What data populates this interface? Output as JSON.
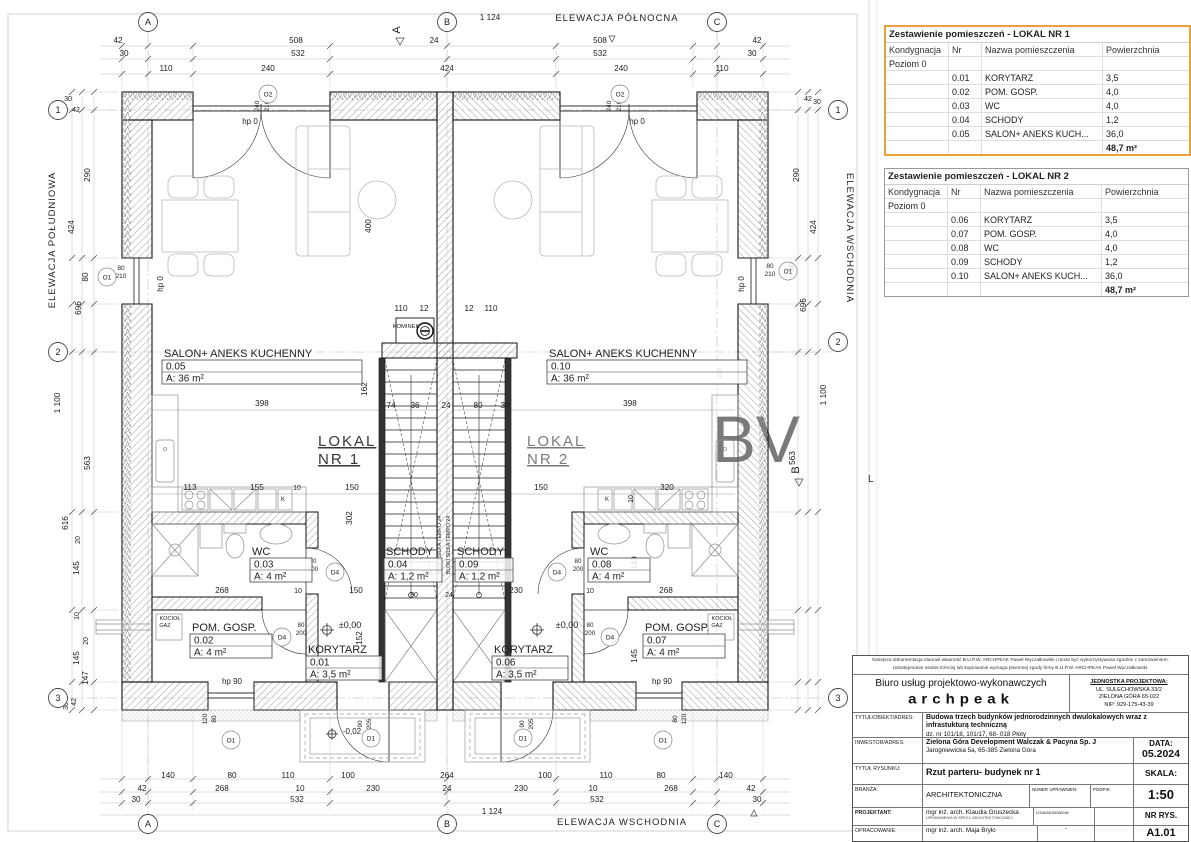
{
  "plan": {
    "elevations": {
      "north": "ELEWACJA PÓŁNOCNA",
      "south": "ELEWACJA POŁUDNIOWA",
      "east_right": "ELEWACJA WSCHODNIA",
      "east_bottom": "ELEWACJA WSCHODNIA"
    },
    "watermark": {
      "big": "BV",
      "small": "L"
    },
    "grid_bubbles": [
      {
        "t": "A",
        "x": 148,
        "y": 22
      },
      {
        "t": "B",
        "x": 447,
        "y": 22
      },
      {
        "t": "C",
        "x": 717,
        "y": 22
      },
      {
        "t": "A",
        "x": 148,
        "y": 824
      },
      {
        "t": "B",
        "x": 447,
        "y": 824
      },
      {
        "t": "C",
        "x": 717,
        "y": 824
      },
      {
        "t": "1",
        "x": 58,
        "y": 110
      },
      {
        "t": "2",
        "x": 58,
        "y": 352
      },
      {
        "t": "3",
        "x": 58,
        "y": 698
      },
      {
        "t": "1",
        "x": 838,
        "y": 110
      },
      {
        "t": "2",
        "x": 838,
        "y": 342
      },
      {
        "t": "3",
        "x": 838,
        "y": 698
      }
    ],
    "section_marks": [
      {
        "t": "A",
        "x": 400,
        "y": 30
      },
      {
        "t": "B",
        "x": 799,
        "y": 470
      }
    ],
    "symbols": [
      {
        "t": "O2",
        "x": 268,
        "y": 94
      },
      {
        "t": "O2",
        "x": 620,
        "y": 94
      },
      {
        "t": "O1",
        "x": 107,
        "y": 277
      },
      {
        "t": "O1",
        "x": 788,
        "y": 271
      },
      {
        "t": "O1",
        "x": 231,
        "y": 740
      },
      {
        "t": "O1",
        "x": 663,
        "y": 740
      },
      {
        "t": "D4",
        "x": 335,
        "y": 572
      },
      {
        "t": "D4",
        "x": 282,
        "y": 637
      },
      {
        "t": "D4",
        "x": 557,
        "y": 572
      },
      {
        "t": "D4",
        "x": 610,
        "y": 637
      },
      {
        "t": "D1",
        "x": 371,
        "y": 738
      },
      {
        "t": "D1",
        "x": 523,
        "y": 738
      }
    ],
    "room_labels": [
      {
        "name": "SALON+ ANEKS KUCHENNY",
        "nr": "0.05",
        "area": "A: 36 m²",
        "x": 162,
        "y": 360,
        "w": 200
      },
      {
        "name": "SALON+ ANEKS KUCHENNY",
        "nr": "0.10",
        "area": "A: 36 m²",
        "x": 547,
        "y": 360,
        "w": 200
      },
      {
        "name": "WC",
        "nr": "0.03",
        "area": "A: 4 m²",
        "x": 250,
        "y": 558,
        "w": 62
      },
      {
        "name": "WC",
        "nr": "0.08",
        "area": "A: 4 m²",
        "x": 588,
        "y": 558,
        "w": 62
      },
      {
        "name": "SCHODY",
        "nr": "0.04",
        "area": "A: 1,2 m²",
        "x": 384,
        "y": 558,
        "w": 58
      },
      {
        "name": "SCHODY",
        "nr": "0.09",
        "area": "A: 1,2 m²",
        "x": 455,
        "y": 558,
        "w": 58
      },
      {
        "name": "POM. GOSP.",
        "nr": "0.02",
        "area": "A: 4 m²",
        "x": 190,
        "y": 634,
        "w": 82
      },
      {
        "name": "POM. GOSP.",
        "nr": "0.07",
        "area": "A: 4 m²",
        "x": 643,
        "y": 634,
        "w": 82
      },
      {
        "name": "KORYTARZ",
        "nr": "0.01",
        "area": "A: 3,5 m²",
        "x": 306,
        "y": 656,
        "w": 76
      },
      {
        "name": "KORYTARZ",
        "nr": "0.06",
        "area": "A: 3,5 m²",
        "x": 492,
        "y": 656,
        "w": 76
      }
    ],
    "unit_marks": [
      {
        "line1": "LOKAL",
        "line2": "NR 1",
        "x": 318,
        "y": 446,
        "color": "#dfa163",
        "opacity": 0.9
      },
      {
        "line1": "LOKAL",
        "line2": "NR 2",
        "x": 527,
        "y": 446,
        "color": "#a3b8d8",
        "opacity": 0.6
      }
    ],
    "dims": [
      [
        "1 124",
        490,
        20
      ],
      [
        "42",
        118,
        43
      ],
      [
        "508",
        296,
        43
      ],
      [
        "24",
        434,
        43
      ],
      [
        "508",
        600,
        43
      ],
      [
        "42",
        757,
        43
      ],
      [
        "30",
        124,
        56
      ],
      [
        "532",
        298,
        56
      ],
      [
        "532",
        600,
        56
      ],
      [
        "30",
        752,
        56
      ],
      [
        "110",
        166,
        71
      ],
      [
        "240",
        268,
        71
      ],
      [
        "424",
        447,
        71
      ],
      [
        "240",
        621,
        71
      ],
      [
        "110",
        722,
        71
      ],
      [
        "240",
        259,
        106,
        1,
        6.5
      ],
      [
        "210",
        269,
        106,
        1,
        6.5
      ],
      [
        "240",
        611,
        106,
        1,
        6.5
      ],
      [
        "210",
        621,
        106,
        1,
        6.5
      ],
      [
        "140",
        168,
        778
      ],
      [
        "80",
        232,
        778
      ],
      [
        "110",
        288,
        778
      ],
      [
        "100",
        348,
        778
      ],
      [
        "264",
        447,
        778
      ],
      [
        "100",
        545,
        778
      ],
      [
        "110",
        606,
        778
      ],
      [
        "80",
        661,
        778
      ],
      [
        "140",
        726,
        778
      ],
      [
        "42",
        142,
        791
      ],
      [
        "268",
        222,
        791
      ],
      [
        "10",
        300,
        791
      ],
      [
        "230",
        373,
        791
      ],
      [
        "24",
        447,
        791
      ],
      [
        "230",
        521,
        791
      ],
      [
        "10",
        593,
        791
      ],
      [
        "268",
        671,
        791
      ],
      [
        "42",
        751,
        791
      ],
      [
        "30",
        136,
        802
      ],
      [
        "532",
        297,
        802
      ],
      [
        "532",
        597,
        802
      ],
      [
        "30",
        757,
        802
      ],
      [
        "1 124",
        492,
        814
      ],
      [
        "90",
        362,
        724,
        1,
        6.5
      ],
      [
        "205",
        371,
        724,
        1,
        6.5
      ],
      [
        "90",
        524,
        724,
        1,
        6.5
      ],
      [
        "205",
        533,
        724,
        1,
        6.5
      ],
      [
        "80",
        677,
        719,
        1,
        6.5
      ],
      [
        "120",
        686,
        719,
        1,
        6.5
      ],
      [
        "80",
        216,
        719,
        1,
        6.5
      ],
      [
        "120",
        207,
        719,
        1,
        6.5
      ],
      [
        "-0,02",
        352,
        734,
        0,
        8
      ],
      [
        "30",
        68,
        101,
        0,
        7
      ],
      [
        "42",
        76,
        112,
        0,
        7
      ],
      [
        "290",
        90,
        175,
        1
      ],
      [
        "424",
        74,
        227,
        1
      ],
      [
        "80",
        88,
        277,
        1
      ],
      [
        "696",
        81,
        308,
        1
      ],
      [
        "1 100",
        60,
        403,
        1
      ],
      [
        "563",
        90,
        463,
        1
      ],
      [
        "616",
        68,
        523,
        1
      ],
      [
        "20",
        80,
        540,
        1,
        7
      ],
      [
        "145",
        79,
        568,
        1
      ],
      [
        "10",
        79,
        616,
        1,
        7
      ],
      [
        "20",
        88,
        641,
        1,
        7
      ],
      [
        "145",
        79,
        658,
        1
      ],
      [
        "147",
        88,
        678,
        1
      ],
      [
        "42",
        76,
        702,
        1,
        7
      ],
      [
        "30",
        68,
        706,
        1,
        7
      ],
      [
        "80",
        121,
        270,
        0,
        6.5
      ],
      [
        "210",
        121,
        278,
        0,
        6.5
      ],
      [
        "42",
        808,
        101,
        0,
        7
      ],
      [
        "30",
        817,
        104,
        0,
        7
      ],
      [
        "290",
        799,
        175,
        1
      ],
      [
        "424",
        816,
        227,
        1
      ],
      [
        "80",
        794,
        267,
        1
      ],
      [
        "696",
        806,
        305,
        1
      ],
      [
        "1 100",
        826,
        395,
        1
      ],
      [
        "563",
        795,
        458,
        1
      ],
      [
        "80",
        770,
        268,
        0,
        6.5
      ],
      [
        "210",
        770,
        276,
        0,
        6.5
      ],
      [
        "398",
        262,
        406
      ],
      [
        "398",
        630,
        406
      ],
      [
        "400",
        371,
        226,
        1
      ],
      [
        "162",
        367,
        389,
        1
      ],
      [
        "110",
        401,
        311
      ],
      [
        "12",
        424,
        311
      ],
      [
        "12",
        469,
        311
      ],
      [
        "110",
        491,
        311
      ],
      [
        "74",
        391,
        408
      ],
      [
        "36",
        415,
        408
      ],
      [
        "24",
        446,
        408
      ],
      [
        "80",
        478,
        408
      ],
      [
        "30",
        505,
        408
      ],
      [
        "113",
        190,
        490
      ],
      [
        "155",
        257,
        490
      ],
      [
        "10",
        297,
        490,
        0,
        7
      ],
      [
        "150",
        352,
        490
      ],
      [
        "150",
        541,
        490
      ],
      [
        "320",
        667,
        490
      ],
      [
        "10",
        633,
        499,
        1,
        7
      ],
      [
        "302",
        352,
        518,
        1
      ],
      [
        "152",
        362,
        638,
        1
      ],
      [
        "149",
        637,
        563,
        1
      ],
      [
        "145",
        637,
        656,
        1
      ],
      [
        "268",
        222,
        593
      ],
      [
        "10",
        298,
        593,
        0,
        7
      ],
      [
        "150",
        356,
        593
      ],
      [
        "80",
        414,
        597,
        0,
        7
      ],
      [
        "24",
        449,
        597,
        0,
        7
      ],
      [
        "230",
        516,
        593
      ],
      [
        "10",
        590,
        593,
        0,
        7
      ],
      [
        "268",
        666,
        593
      ],
      [
        "80",
        313,
        563,
        0,
        6.2
      ],
      [
        "200",
        313,
        571,
        0,
        6.2
      ],
      [
        "80",
        301,
        627,
        0,
        6.2
      ],
      [
        "200",
        301,
        635,
        0,
        6.2
      ],
      [
        "80",
        578,
        563,
        0,
        6.2
      ],
      [
        "200",
        578,
        571,
        0,
        6.2
      ],
      [
        "80",
        590,
        627,
        0,
        6.2
      ],
      [
        "200",
        590,
        635,
        0,
        6.2
      ],
      [
        "±0,00",
        350,
        628,
        0,
        9
      ],
      [
        "±0,00",
        567,
        628,
        0,
        9
      ],
      [
        "hp 0",
        250,
        124,
        0,
        8
      ],
      [
        "hp 0",
        637,
        124,
        0,
        8
      ],
      [
        "hp 0",
        163,
        284,
        1,
        8
      ],
      [
        "hp 0",
        744,
        284,
        1,
        8
      ],
      [
        "hp 90",
        232,
        684,
        0,
        8
      ],
      [
        "hp 90",
        662,
        684,
        0,
        8
      ],
      [
        "KOMINEK",
        406,
        328,
        0,
        5.8
      ],
      [
        "KOCIOŁ",
        170,
        620,
        0,
        5.5
      ],
      [
        "GAZ",
        165,
        627,
        0,
        5.5
      ],
      [
        "KOCIOŁ",
        722,
        620,
        0,
        5.5
      ],
      [
        "GAZ",
        717,
        627,
        0,
        5.5
      ],
      [
        "ZM",
        170,
        373,
        1,
        7,
        "#999"
      ],
      [
        "ZM",
        722,
        373,
        1,
        7,
        "#999"
      ],
      [
        "K",
        283,
        501,
        0,
        6
      ],
      [
        "K",
        607,
        501,
        0,
        6
      ],
      [
        "BLOKI SILKA TEMPO 24",
        441,
        545,
        1,
        5.2,
        "#888"
      ],
      [
        "BLOKI SILKA TEMPO 24",
        450,
        545,
        1,
        5.2,
        "#888"
      ]
    ]
  },
  "tables": [
    {
      "title": "Zestawienie pomieszczeń - LOKAL NR 1",
      "headers": [
        "Kondygnacja",
        "Nr",
        "Nazwa pomieszczenia",
        "Powierzchnia"
      ],
      "level": "Poziom 0",
      "rows": [
        [
          "0.01",
          "KORYTARZ",
          "3,5"
        ],
        [
          "0.02",
          "POM. GOSP.",
          "4,0"
        ],
        [
          "0.03",
          "WC",
          "4,0"
        ],
        [
          "0.04",
          "SCHODY",
          "1,2"
        ],
        [
          "0.05",
          "SALON+ ANEKS KUCH...",
          "36,0"
        ]
      ],
      "total": "48,7 m²"
    },
    {
      "title": "Zestawienie pomieszczeń - LOKAL NR 2",
      "headers": [
        "Kondygnacja",
        "Nr",
        "Nazwa pomieszczenia",
        "Powierzchnia"
      ],
      "level": "Poziom 0",
      "rows": [
        [
          "0.06",
          "KORYTARZ",
          "3,5"
        ],
        [
          "0.07",
          "POM. GOSP.",
          "4,0"
        ],
        [
          "0.08",
          "WC",
          "4,0"
        ],
        [
          "0.09",
          "SCHODY",
          "1,2"
        ],
        [
          "0.10",
          "SALON+ ANEKS KUCH...",
          "36,0"
        ]
      ],
      "total": "48,7 m²"
    }
  ],
  "titleblock": {
    "disclaimer1": "Niniejsza dokumentacja stanowi własność B.U.P.W. ARCHPEAK Paweł Wyczałkowski i może być wykorzystywana zgodnie z zamówieniem.",
    "disclaimer2": "Udostępnianie osobie trzeciej lub kopiowanie wymaga pisemnej zgody firmy B.U.P.W. ARCHPEAK Paweł Wyczałkowski.",
    "office_line": "Biuro usług projektowo-wykonawczych",
    "logo": "archpeak",
    "jednostka_label": "JEDNOSTKA PROJEKTOWA:",
    "jednostka1": "UL. SULECHOWSKA 33/2",
    "jednostka2": "ZIELONA GÓRA 65-022",
    "jednostka3": "NIP: 929-175-43-39",
    "tytul_label": "TYTUŁ/OBIEKT/ADRES:",
    "tytul_value": "Budowa trzech budynków jednorodzinnych dwulokalowych wraz z infrastukturą techniczną",
    "tytul_value2": "dz. nr 101/18, 101/17, 68- 018 Płoty",
    "inwestor_label": "INWESTOR/ADRES:",
    "inwestor_value": "Zielona Góra Development Walczak & Pacyna Sp. J",
    "inwestor_value2": "Jarogniewicka 5a, 65-385 Zielona Góra",
    "data_label": "DATA:",
    "data_value": "05.2024",
    "rysunek_label": "TYTUŁ RYSUNKU:",
    "rysunek_value": "Rzut parteru- budynek nr 1",
    "skala_label": "SKALA:",
    "skala_value": "1:50",
    "branza_label": "BRANŻA:",
    "branza_value": "ARCHITEKTONICZNA",
    "numer_label": "NUMER UPRAWNIEŃ:",
    "podpis_label": "PODPIS:",
    "projektant_label": "PROJEKTANT:",
    "projektant_value": "mgr inż. arch. Klaudia Gruszecka",
    "projektant_sub": "UPRAWNIENIA W SPECJ. ARCHITEKTONICZNEJ",
    "projektant_numer": "LOIA/26/2008/GW",
    "opracowanie_label": "OPRACOWANIE:",
    "opracowanie_value": "mgr inż. arch. Maja Bryło",
    "opracowanie_dash": "-",
    "nrrys_label": "NR RYS.",
    "nrrys_value": "A1.01"
  }
}
